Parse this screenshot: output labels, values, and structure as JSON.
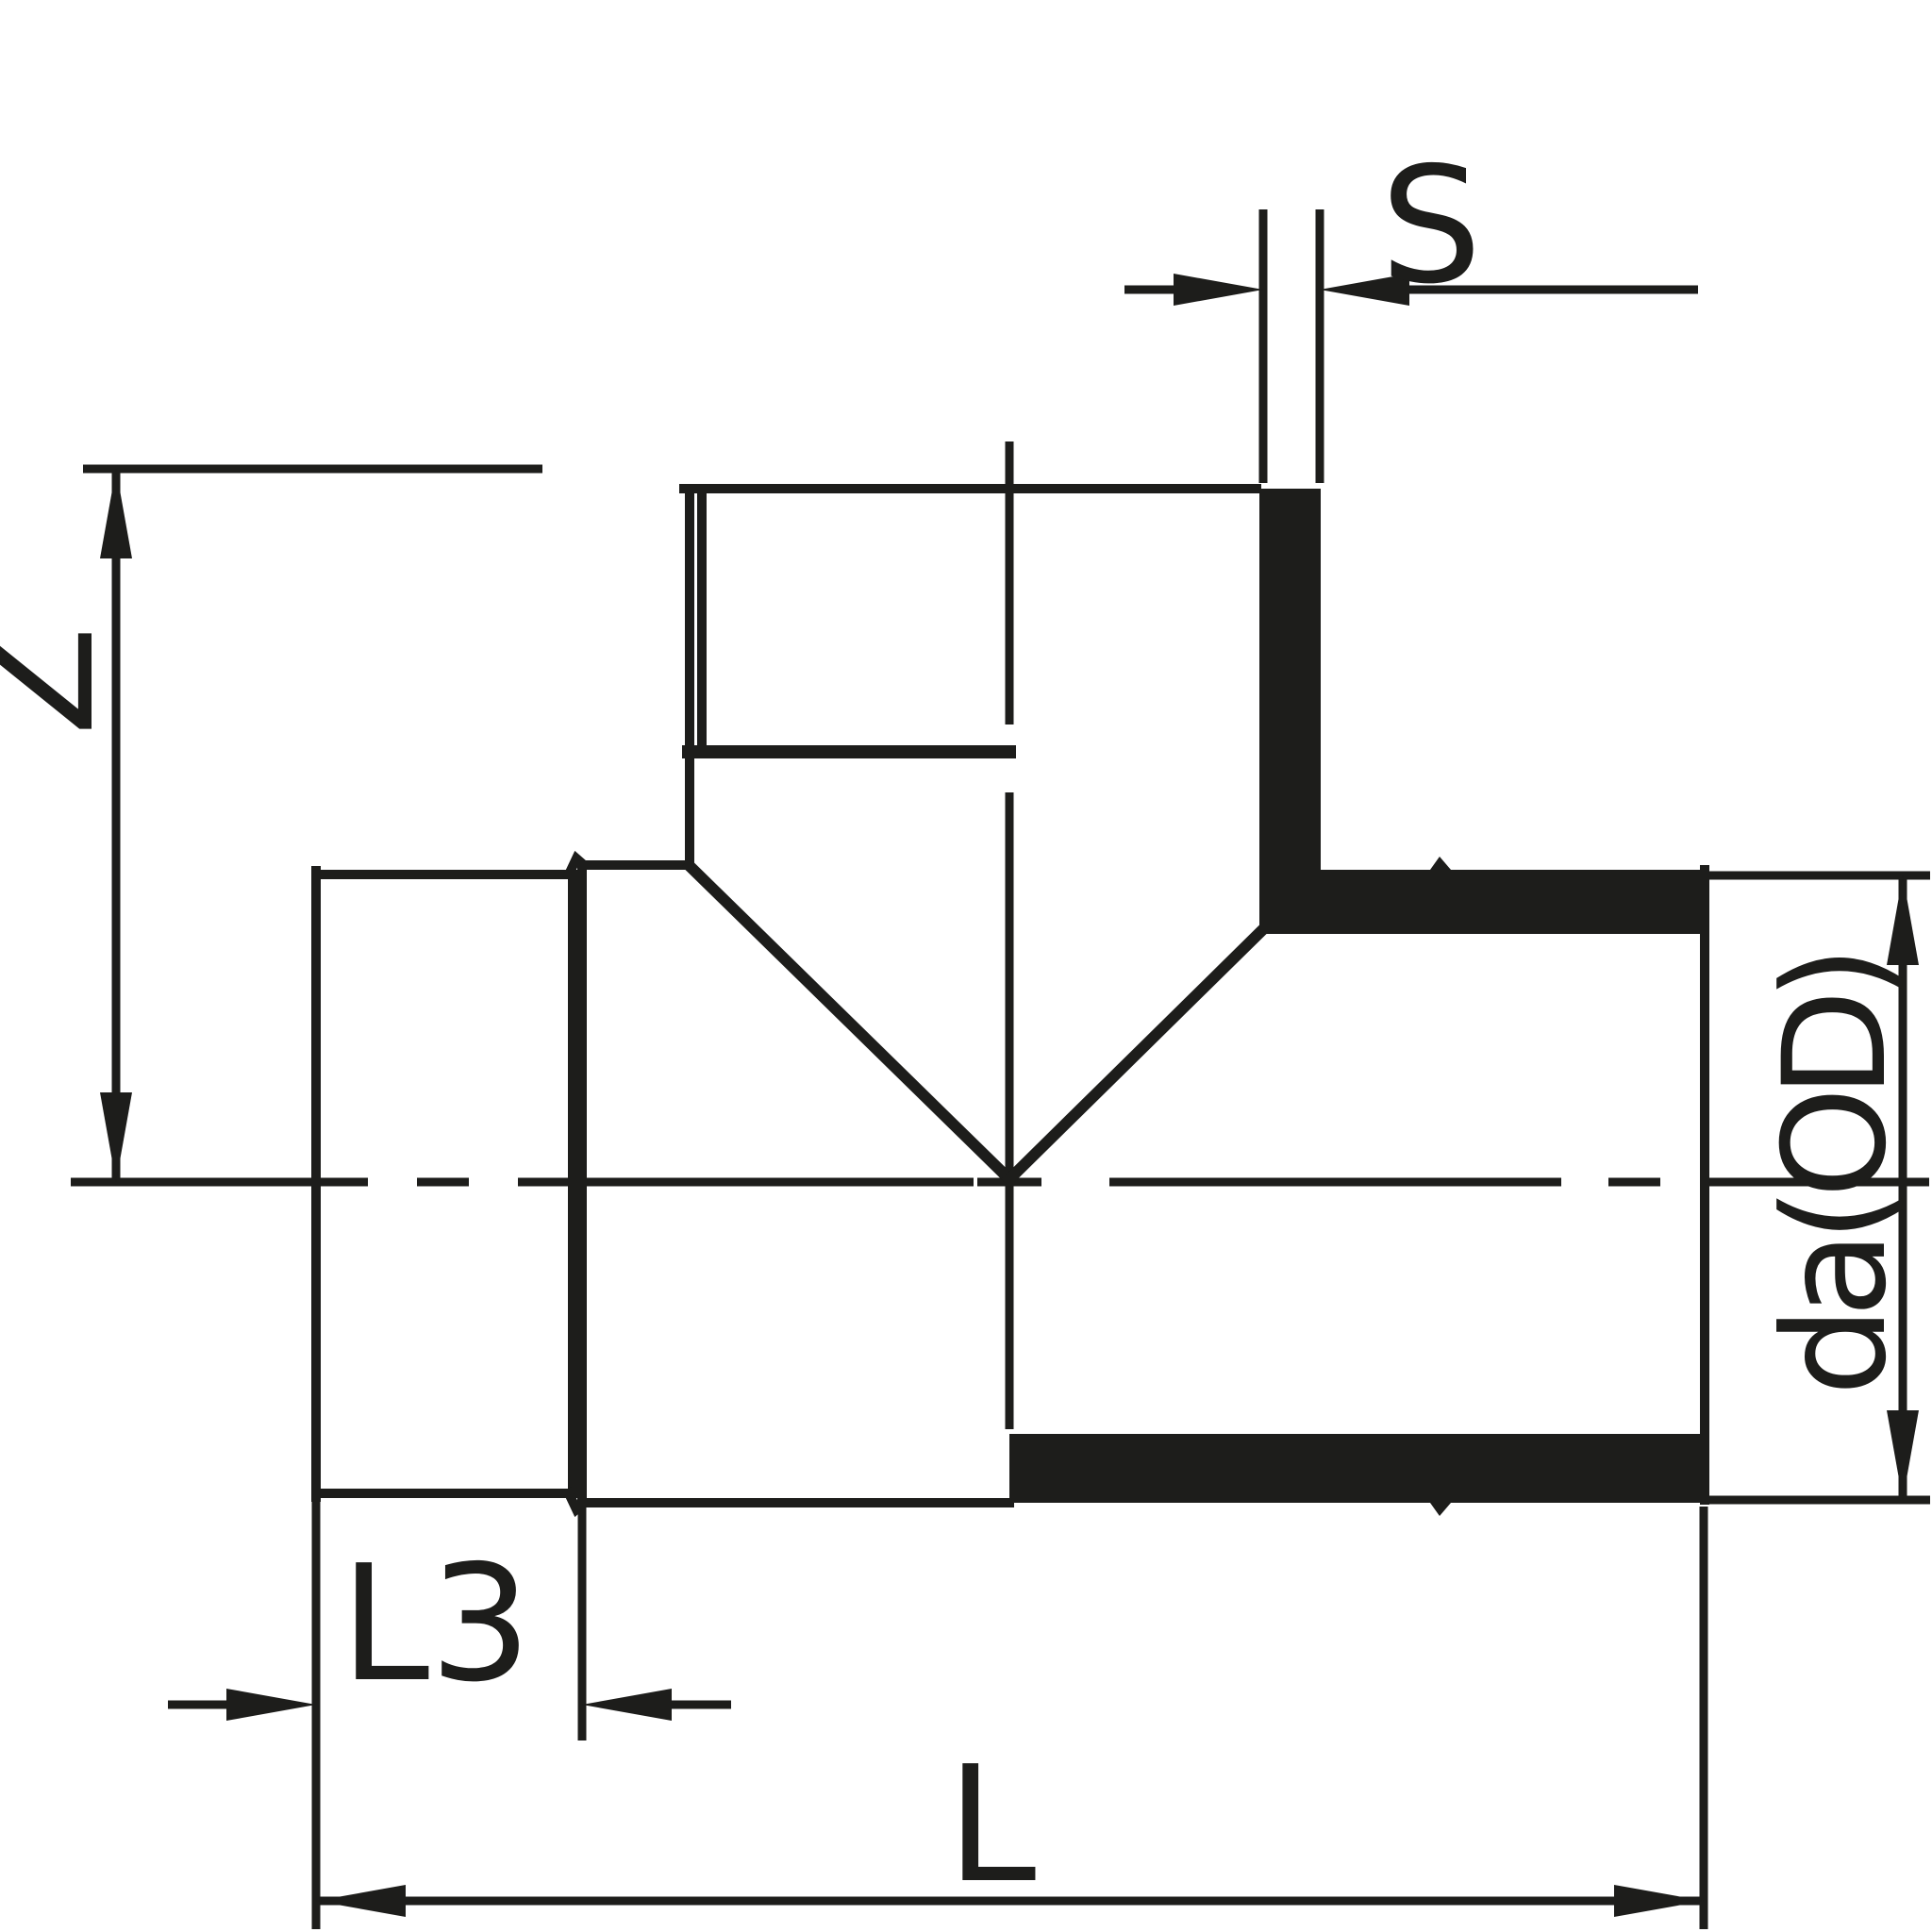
{
  "drawing": {
    "title": "Tee fitting cross-section technical drawing",
    "labels": {
      "wall_thickness": "S",
      "branch_height": "Z",
      "socket_depth": "L3",
      "overall_length": "L",
      "outer_diameter": "da(OD)"
    },
    "colors": {
      "ink": "#1d1d1b",
      "background": "#ffffff"
    }
  }
}
